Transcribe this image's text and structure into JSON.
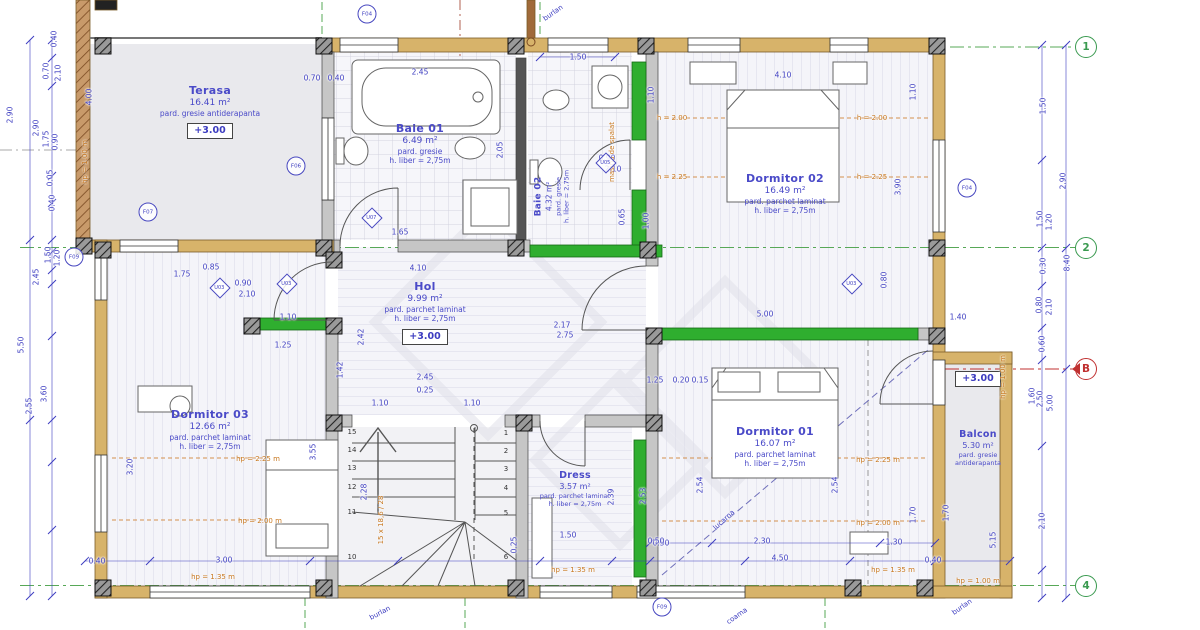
{
  "rooms": [
    {
      "id": "terasa",
      "name": "Terasa",
      "area": "16.41 m²",
      "floor": "pard. gresie antiderapanta",
      "level": "+3.00"
    },
    {
      "id": "baie-01",
      "name": "Baie 01",
      "area": "6.49 m²",
      "floor": "pard. gresie",
      "height": "h. liber = 2,75m"
    },
    {
      "id": "baie-02",
      "name": "Baie 02",
      "area": "4.32 m²",
      "floor": "pard. gresie",
      "height": "h. liber = 2,75m"
    },
    {
      "id": "dormitor-02",
      "name": "Dormitor 02",
      "area": "16.49 m²",
      "floor": "pard. parchet laminat",
      "height": "h. liber = 2,75m"
    },
    {
      "id": "hol",
      "name": "Hol",
      "area": "9.99 m²",
      "floor": "pard. parchet laminat",
      "height": "h. liber = 2,75m",
      "level": "+3.00"
    },
    {
      "id": "dormitor-03",
      "name": "Dormitor 03",
      "area": "12.66 m²",
      "floor": "pard. parchet laminat",
      "height": "h. liber = 2,75m"
    },
    {
      "id": "dress",
      "name": "Dress",
      "area": "3.57 m²",
      "floor": "pard. parchet laminat",
      "height": "h. liber = 2,75m"
    },
    {
      "id": "dormitor-01",
      "name": "Dormitor 01",
      "area": "16.07 m²",
      "floor": "pard. parchet laminat",
      "height": "h. liber = 2,75m"
    },
    {
      "id": "balcon",
      "name": "Balcon",
      "area": "5.30 m²",
      "floor": "pard. gresie",
      "floor2": "antiderapanta",
      "level": "+3.00"
    }
  ],
  "dimensions": [
    {
      "t": "0.40",
      "x": 54,
      "y": 39,
      "o": "v"
    },
    {
      "t": "0.70",
      "x": 46,
      "y": 71,
      "o": "v"
    },
    {
      "t": "2.10",
      "x": 58,
      "y": 73,
      "o": "v"
    },
    {
      "t": "2.90",
      "x": 10,
      "y": 115,
      "o": "v"
    },
    {
      "t": "2.90",
      "x": 36,
      "y": 128,
      "o": "v"
    },
    {
      "t": "1.75",
      "x": 46,
      "y": 139,
      "o": "v"
    },
    {
      "t": "0.90",
      "x": 55,
      "y": 142,
      "o": "v"
    },
    {
      "t": "0.05",
      "x": 50,
      "y": 178,
      "o": "v"
    },
    {
      "t": "0.40",
      "x": 52,
      "y": 203,
      "o": "v"
    },
    {
      "t": "1.50",
      "x": 48,
      "y": 255,
      "o": "v"
    },
    {
      "t": "1.20",
      "x": 57,
      "y": 258,
      "o": "v"
    },
    {
      "t": "2.45",
      "x": 36,
      "y": 277,
      "o": "v"
    },
    {
      "t": "5.50",
      "x": 21,
      "y": 345,
      "o": "v"
    },
    {
      "t": "3.60",
      "x": 44,
      "y": 394,
      "o": "v"
    },
    {
      "t": "2.55",
      "x": 29,
      "y": 406,
      "o": "v"
    },
    {
      "t": "4.00",
      "x": 89,
      "y": 97,
      "o": "v"
    },
    {
      "t": "0.40",
      "x": 97,
      "y": 561,
      "o": "h"
    },
    {
      "t": "0.70",
      "x": 312,
      "y": 78,
      "o": "h"
    },
    {
      "t": "0.40",
      "x": 336,
      "y": 78,
      "o": "h"
    },
    {
      "t": "2.45",
      "x": 420,
      "y": 72,
      "o": "h"
    },
    {
      "t": "1.65",
      "x": 400,
      "y": 232,
      "o": "h"
    },
    {
      "t": "2.05",
      "x": 500,
      "y": 150,
      "o": "v"
    },
    {
      "t": "1.50",
      "x": 578,
      "y": 57,
      "o": "h"
    },
    {
      "t": "1.10",
      "x": 651,
      "y": 95,
      "o": "v"
    },
    {
      "t": "0.90",
      "x": 607,
      "y": 158,
      "o": "h"
    },
    {
      "t": "2.10",
      "x": 613,
      "y": 169,
      "o": "h"
    },
    {
      "t": "0.65",
      "x": 622,
      "y": 217,
      "o": "v"
    },
    {
      "t": "1.00",
      "x": 646,
      "y": 221,
      "o": "v"
    },
    {
      "t": "4.10",
      "x": 783,
      "y": 75,
      "o": "h"
    },
    {
      "t": "1.10",
      "x": 913,
      "y": 92,
      "o": "v"
    },
    {
      "t": "3.90",
      "x": 898,
      "y": 187,
      "o": "v"
    },
    {
      "t": "1.50",
      "x": 1043,
      "y": 106,
      "o": "v"
    },
    {
      "t": "2.90",
      "x": 1063,
      "y": 181,
      "o": "v"
    },
    {
      "t": "1.50",
      "x": 1040,
      "y": 219,
      "o": "v"
    },
    {
      "t": "1.20",
      "x": 1049,
      "y": 222,
      "o": "v"
    },
    {
      "t": "0.30",
      "x": 1043,
      "y": 266,
      "o": "v"
    },
    {
      "t": "0.80",
      "x": 1039,
      "y": 305,
      "o": "v"
    },
    {
      "t": "2.10",
      "x": 1049,
      "y": 307,
      "o": "v"
    },
    {
      "t": "0.60",
      "x": 1042,
      "y": 344,
      "o": "v"
    },
    {
      "t": "8.40",
      "x": 1067,
      "y": 263,
      "o": "v"
    },
    {
      "t": "1.60",
      "x": 1032,
      "y": 396,
      "o": "v"
    },
    {
      "t": "2.50",
      "x": 1040,
      "y": 399,
      "o": "v"
    },
    {
      "t": "5.00",
      "x": 1050,
      "y": 403,
      "o": "v"
    },
    {
      "t": "2.10",
      "x": 1042,
      "y": 521,
      "o": "v"
    },
    {
      "t": "4.10",
      "x": 418,
      "y": 268,
      "o": "h"
    },
    {
      "t": "2.42",
      "x": 361,
      "y": 337,
      "o": "v"
    },
    {
      "t": "1.42",
      "x": 340,
      "y": 370,
      "o": "v"
    },
    {
      "t": "2.45",
      "x": 425,
      "y": 377,
      "o": "h"
    },
    {
      "t": "0.25",
      "x": 425,
      "y": 390,
      "o": "h"
    },
    {
      "t": "1.10",
      "x": 380,
      "y": 403,
      "o": "h"
    },
    {
      "t": "1.10",
      "x": 472,
      "y": 403,
      "o": "h"
    },
    {
      "t": "1.25",
      "x": 283,
      "y": 345,
      "o": "h"
    },
    {
      "t": "1.10",
      "x": 288,
      "y": 317,
      "o": "h"
    },
    {
      "t": "1.75",
      "x": 182,
      "y": 274,
      "o": "h"
    },
    {
      "t": "0.85",
      "x": 211,
      "y": 267,
      "o": "h"
    },
    {
      "t": "0.90",
      "x": 243,
      "y": 283,
      "o": "h"
    },
    {
      "t": "2.10",
      "x": 247,
      "y": 294,
      "o": "h"
    },
    {
      "t": "2.17",
      "x": 562,
      "y": 325,
      "o": "h"
    },
    {
      "t": "2.75",
      "x": 565,
      "y": 335,
      "o": "h"
    },
    {
      "t": "1.25",
      "x": 655,
      "y": 380,
      "o": "h"
    },
    {
      "t": "0.20",
      "x": 681,
      "y": 380,
      "o": "h"
    },
    {
      "t": "0.15",
      "x": 700,
      "y": 380,
      "o": "h"
    },
    {
      "t": "5.00",
      "x": 765,
      "y": 314,
      "o": "h"
    },
    {
      "t": "1.40",
      "x": 958,
      "y": 317,
      "o": "h"
    },
    {
      "t": "0.80",
      "x": 884,
      "y": 280,
      "o": "v"
    },
    {
      "t": "2.28",
      "x": 364,
      "y": 492,
      "o": "v"
    },
    {
      "t": "0.25",
      "x": 514,
      "y": 545,
      "o": "v"
    },
    {
      "t": "3.20",
      "x": 130,
      "y": 467,
      "o": "v"
    },
    {
      "t": "3.55",
      "x": 313,
      "y": 452,
      "o": "v"
    },
    {
      "t": "3.00",
      "x": 224,
      "y": 560,
      "o": "h"
    },
    {
      "t": "1.50",
      "x": 568,
      "y": 535,
      "o": "h"
    },
    {
      "t": "2.39",
      "x": 611,
      "y": 497,
      "o": "v"
    },
    {
      "t": "2.53",
      "x": 643,
      "y": 496,
      "o": "v"
    },
    {
      "t": "0.50",
      "x": 661,
      "y": 543,
      "o": "h"
    },
    {
      "t": "2.54",
      "x": 700,
      "y": 485,
      "o": "v"
    },
    {
      "t": "2.54",
      "x": 835,
      "y": 485,
      "o": "v"
    },
    {
      "t": "2.30",
      "x": 762,
      "y": 541,
      "o": "h"
    },
    {
      "t": "4.50",
      "x": 780,
      "y": 558,
      "o": "h"
    },
    {
      "t": "1.30",
      "x": 894,
      "y": 542,
      "o": "h"
    },
    {
      "t": "0.50",
      "x": 656,
      "y": 541,
      "o": "h"
    },
    {
      "t": "1.70",
      "x": 913,
      "y": 515,
      "o": "v"
    },
    {
      "t": "0.40",
      "x": 933,
      "y": 560,
      "o": "h"
    },
    {
      "t": "5.15",
      "x": 993,
      "y": 540,
      "o": "v"
    },
    {
      "t": "1.70",
      "x": 946,
      "y": 513,
      "o": "v"
    }
  ],
  "annotations": [
    {
      "t": "hp = 1.00 m",
      "x": 85,
      "y": 162,
      "o": "v",
      "c": "orange"
    },
    {
      "t": "h = 2.00",
      "x": 672,
      "y": 118,
      "c": "orange"
    },
    {
      "t": "h = 2.00",
      "x": 872,
      "y": 118,
      "c": "orange"
    },
    {
      "t": "h = 2.25",
      "x": 672,
      "y": 177,
      "c": "orange"
    },
    {
      "t": "h = 2.25",
      "x": 872,
      "y": 177,
      "c": "orange"
    },
    {
      "t": "hp = 2.25 m",
      "x": 258,
      "y": 459,
      "c": "orange"
    },
    {
      "t": "hp = 2.00 m",
      "x": 260,
      "y": 521,
      "c": "orange"
    },
    {
      "t": "hp = 1.35 m",
      "x": 213,
      "y": 577,
      "c": "orange"
    },
    {
      "t": "hp = 2.25 m",
      "x": 878,
      "y": 460,
      "c": "orange"
    },
    {
      "t": "hp = 2.00 m",
      "x": 878,
      "y": 523,
      "c": "orange"
    },
    {
      "t": "hp = 1.35 m",
      "x": 893,
      "y": 570,
      "c": "orange"
    },
    {
      "t": "hp = 1.35 m",
      "x": 573,
      "y": 570,
      "c": "orange"
    },
    {
      "t": "hp = 1.00 m",
      "x": 978,
      "y": 581,
      "c": "orange"
    },
    {
      "t": "hp = 1.00 m",
      "x": 1003,
      "y": 377,
      "o": "v",
      "c": "orange"
    },
    {
      "t": "masina de spalat",
      "x": 612,
      "y": 152,
      "o": "v",
      "c": "orange"
    },
    {
      "t": "15 x 18,6 / 28",
      "x": 381,
      "y": 520,
      "o": "v",
      "c": "orange"
    },
    {
      "t": "burlan",
      "x": 553,
      "y": 13,
      "rot": -35,
      "c": "blue"
    },
    {
      "t": "burlan",
      "x": 380,
      "y": 613,
      "rot": -28,
      "c": "blue"
    },
    {
      "t": "coama",
      "x": 737,
      "y": 616,
      "rot": -35,
      "c": "blue"
    },
    {
      "t": "burlan",
      "x": 962,
      "y": 607,
      "rot": -35,
      "c": "blue"
    },
    {
      "t": "lucarna",
      "x": 724,
      "y": 520,
      "rot": -42,
      "c": "blue"
    }
  ],
  "f_markers": [
    {
      "code": "F04",
      "x": 367,
      "y": 14
    },
    {
      "code": "F06",
      "x": 296,
      "y": 166
    },
    {
      "code": "F07",
      "x": 148,
      "y": 212
    },
    {
      "code": "F09",
      "x": 74,
      "y": 257
    },
    {
      "code": "F04",
      "x": 967,
      "y": 188
    },
    {
      "code": "F09",
      "x": 662,
      "y": 607
    }
  ],
  "u_markers": [
    {
      "code": "U07",
      "x": 372,
      "y": 218
    },
    {
      "code": "U03",
      "x": 220,
      "y": 288
    },
    {
      "code": "U03",
      "x": 287,
      "y": 284
    },
    {
      "code": "U05",
      "x": 606,
      "y": 163
    },
    {
      "code": "U03",
      "x": 852,
      "y": 284
    }
  ],
  "grid_markers": [
    {
      "label": "1",
      "x": 1086,
      "y": 47,
      "color": "green"
    },
    {
      "label": "2",
      "x": 1086,
      "y": 248,
      "color": "green"
    },
    {
      "label": "B",
      "x": 1086,
      "y": 369,
      "color": "red"
    },
    {
      "label": "4",
      "x": 1086,
      "y": 586,
      "color": "green"
    }
  ],
  "stairs": {
    "left": [
      "15",
      "14",
      "13",
      "12",
      "11",
      "10"
    ],
    "right": [
      "1",
      "2",
      "3",
      "4",
      "5",
      "6"
    ],
    "left_x": 352,
    "right_x": 506,
    "left_ys": [
      432,
      450,
      468,
      487,
      512,
      557
    ],
    "right_ys": [
      433,
      451,
      469,
      488,
      513,
      557
    ]
  },
  "colors": {
    "wall_tan": "#d7b36a",
    "wall_green": "#2fae2f",
    "dim_blue": "#3c3cc0",
    "annot_orange": "#c87820",
    "marker_green": "#3a9a50",
    "marker_red": "#c03030",
    "terasa_fill": "#e9e9ed"
  }
}
